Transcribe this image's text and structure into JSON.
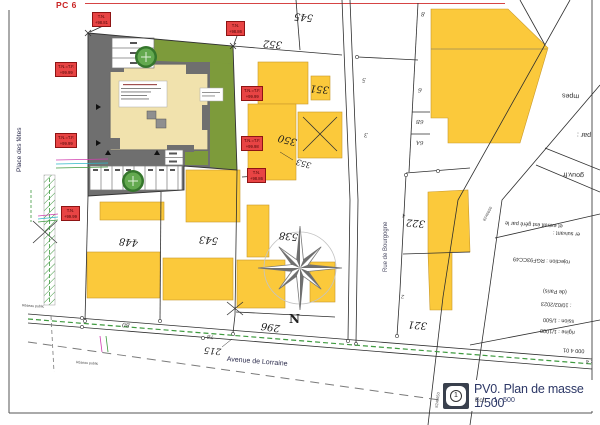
{
  "header": {
    "pc_label": "PC 6"
  },
  "streets": {
    "place_des_fetes": "Place des fêtes",
    "avenue_de_lorraine": "Avenue de Lorraine",
    "rue_de_bourgogne": "Rue de Bourgogne"
  },
  "parcels": {
    "p545": "545",
    "p352": "352",
    "p351": "351",
    "p350": "350",
    "p353": "353",
    "p322": "322",
    "p321": "321",
    "p296": "296",
    "p538": "538",
    "p543": "543",
    "p448": "448",
    "p215": "215"
  },
  "house_numbers": {
    "n8": "8",
    "n6": "6",
    "n6b": "6B",
    "n6a": "6A",
    "n5": "5",
    "n3": "3",
    "n4": "4",
    "n2": "2",
    "n80": "80",
    "n78": "78"
  },
  "compass": {
    "north": "N"
  },
  "elevations": [
    {
      "l1": "T.N.",
      "l2": "+98.81"
    },
    {
      "l1": "T.N.",
      "l2": "+98.86"
    },
    {
      "l1": "T.N.=T.F.",
      "l2": "+99.99"
    },
    {
      "l1": "T.N.=T.F.",
      "l2": "+99.99"
    },
    {
      "l1": "T.N.",
      "l2": "+99.99"
    },
    {
      "l1": "T.N.=T.F.",
      "l2": "+99.99"
    },
    {
      "l1": "T.N.=T.F.",
      "l2": "+99.98"
    },
    {
      "l1": "T.N.",
      "l2": "+98.86"
    }
  ],
  "utilities": {
    "reseau_public": "Réseau public"
  },
  "road_ids": {
    "id1": "8240650",
    "id2": "8240650"
  },
  "cadastre_stamp": {
    "lines": [
      "mpes",
      "par :",
      "gouv.fr",
      "et extrait est géré par le",
      "er suivant :",
      "rojection : RGF93CC49",
      "(de Paris)",
      ": 10/02/2023",
      "ssion : 1/500",
      "rigine : 1/1000",
      "000 4 01",
      ": 4",
      "ommune"
    ]
  },
  "title_block": {
    "sheet_number": "1",
    "title": "PV0. Plan de masse 1/500",
    "scale_label": "Ech :",
    "scale_value": "1 : 500"
  },
  "colors": {
    "cadastre_yellow": "#FBC93B",
    "site_green": "#7D9B3B",
    "site_gray": "#6F6F6F",
    "building_beige": "#F1E2AD",
    "elevation_red": "#E84444",
    "title_navy": "#2C3766",
    "utility_green": "#3F9A3F"
  }
}
